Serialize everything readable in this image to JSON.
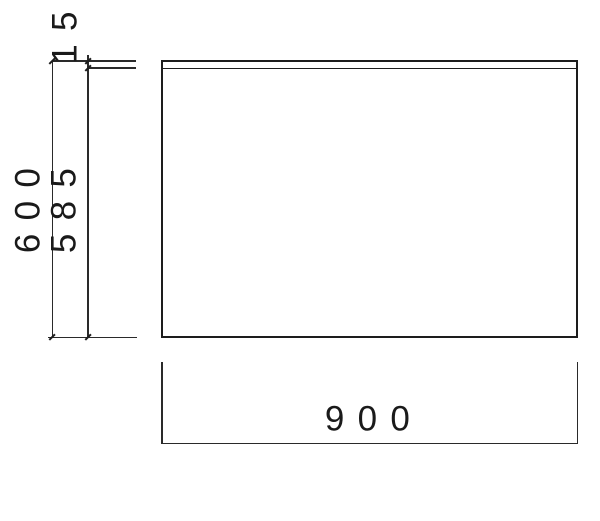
{
  "drawing": {
    "type": "panel-front-view-with-dimensions",
    "dimensions": {
      "top_thickness": "15",
      "overall_height": "600",
      "inner_height": "585",
      "overall_width": "900"
    },
    "colors": {
      "line": "#2a2a2a",
      "panel_outline": "#1d1d1d",
      "text": "#1a1a1a",
      "background": "#ffffff"
    }
  }
}
